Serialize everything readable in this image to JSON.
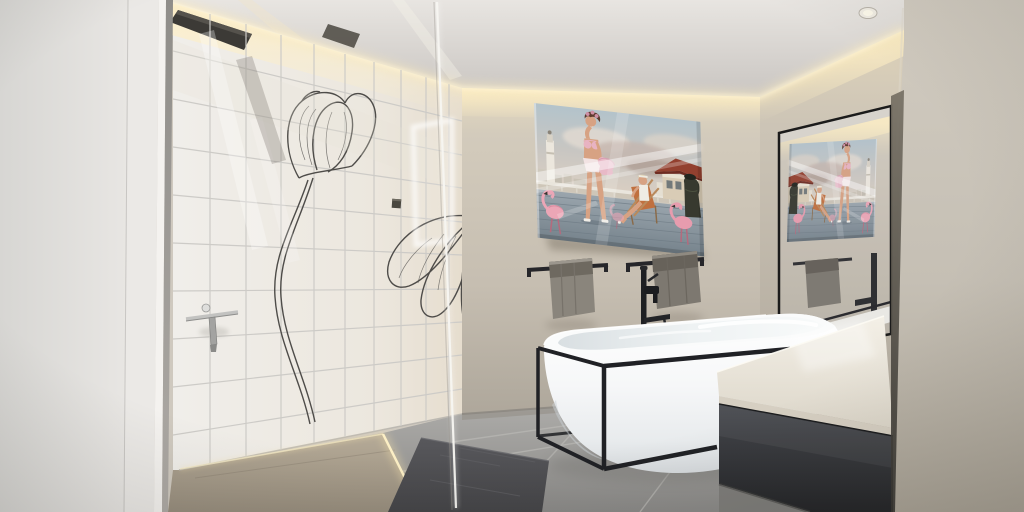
{
  "scene": {
    "type": "photograph",
    "room": "bathroom",
    "description": "Modern bathroom: walk-in shower with white tiles decorated with black tulip line-art, glass partition, ceiling rain shower, retro artwork of two women with pink flamingos on a seaside deck, black towel rails with grey towels, freestanding white bathtub in a black steel frame with a black floor-standing tap, dark floating vanity with white stone countertop, large black-framed wall mirror reflecting the artwork, warm LED cove lighting, grey tiled floor with a dark bath mat."
  },
  "objects": [
    "ceiling-rain-shower",
    "cove-light",
    "recessed-spotlight",
    "tiled-shower-wall",
    "tulip-line-art",
    "glass-partition",
    "shower-squeegee",
    "flamingo-artwork",
    "towel-rail-left",
    "towel-rail-right",
    "grey-towel-left",
    "grey-towel-right",
    "freestanding-bathtub",
    "black-tub-frame",
    "floor-standing-tap",
    "floating-vanity",
    "white-countertop",
    "wall-mirror",
    "led-floor-strip",
    "bath-mat",
    "grey-floor-tiles",
    "beige-back-wall",
    "white-door-frame"
  ],
  "palette": {
    "wall_beige": "#c9c2b6",
    "tile_white": "#f1efec",
    "grout": "#cdcbc7",
    "cove_glow": "#ffeec9",
    "ceiling": "#d9d6d2",
    "floor_grey": "#9b9a98",
    "shower_floor": "#a89d8c",
    "towel_grey": "#847f77",
    "frame_black": "#1f2023",
    "vanity_dark": "#35373b",
    "counter_white": "#ece7dc",
    "tub_white": "#f7f8f9",
    "mat_dark": "#4c4c4f",
    "flamingo_pink": "#eba6b6",
    "roof_red": "#8e3b2e",
    "sky_blue": "#b3c3cb"
  }
}
